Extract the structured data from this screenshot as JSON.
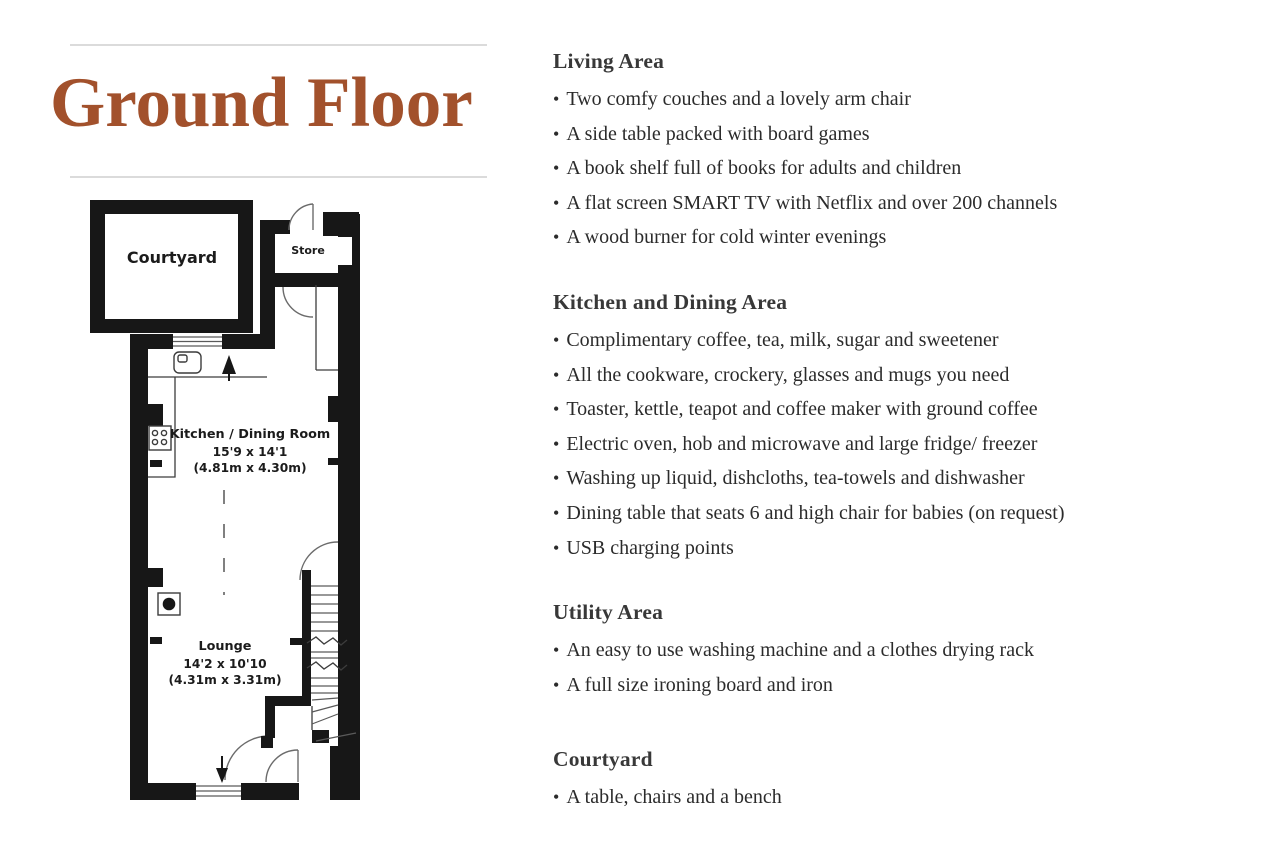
{
  "title": {
    "text": "Ground Floor",
    "color": "#a2512c"
  },
  "divider_color": "#dbdbdb",
  "bullet": "•",
  "floorplan": {
    "wall_color": "#171717",
    "courtyard_label": "Courtyard",
    "store_label": "Store",
    "kitchen": {
      "name": "Kitchen / Dining Room",
      "dims_imperial": "15'9 x 14'1",
      "dims_metric": "(4.81m x 4.30m)"
    },
    "lounge": {
      "name": "Lounge",
      "dims_imperial": "14'2 x 10'10",
      "dims_metric": "(4.31m x 3.31m)"
    }
  },
  "sections": [
    {
      "heading": "Living Area",
      "items": [
        "Two comfy couches and a lovely arm chair",
        "A side table packed with board games",
        "A book shelf full of books for adults and children",
        "A flat screen SMART TV with Netflix and over 200 channels",
        "A wood burner for cold winter evenings"
      ]
    },
    {
      "heading": "Kitchen and Dining Area",
      "items": [
        "Complimentary coffee, tea, milk, sugar and sweetener",
        "All the cookware, crockery, glasses and mugs you need",
        "Toaster, kettle, teapot and coffee maker with ground coffee",
        "Electric oven, hob and microwave and large fridge/ freezer",
        "Washing up liquid, dishcloths, tea-towels and dishwasher",
        "Dining table that seats 6 and high chair for babies (on request)",
        "USB charging points"
      ]
    },
    {
      "heading": "Utility Area",
      "items": [
        "An easy to use washing machine and a clothes drying rack",
        "A full size ironing board and iron"
      ]
    },
    {
      "heading": "Courtyard",
      "items": [
        "A table, chairs and a bench"
      ]
    }
  ]
}
